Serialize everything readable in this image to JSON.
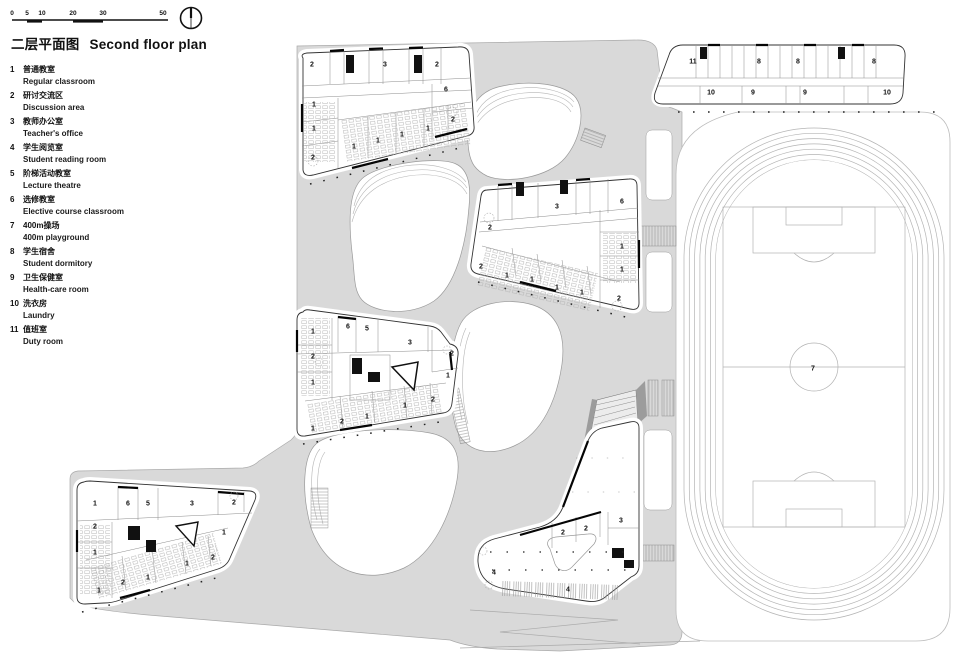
{
  "header": {
    "title_zh": "二层平面图",
    "title_en": "Second floor plan",
    "scale_ticks": [
      {
        "t": "0",
        "x": 2
      },
      {
        "t": "5",
        "x": 17
      },
      {
        "t": "10",
        "x": 32
      },
      {
        "t": "20",
        "x": 63
      },
      {
        "t": "30",
        "x": 93
      },
      {
        "t": "50",
        "x": 153
      }
    ]
  },
  "legend": {
    "items": [
      {
        "num": "1",
        "zh": "普通教室",
        "en": "Regular classroom"
      },
      {
        "num": "2",
        "zh": "研讨交流区",
        "en": "Discussion area"
      },
      {
        "num": "3",
        "zh": "教师办公室",
        "en": "Teacher's office"
      },
      {
        "num": "4",
        "zh": "学生阅览室",
        "en": "Student reading room"
      },
      {
        "num": "5",
        "zh": "阶梯活动教室",
        "en": "Lecture theatre"
      },
      {
        "num": "6",
        "zh": "选修教室",
        "en": "Elective course classroom"
      },
      {
        "num": "7",
        "zh": "400m操场",
        "en": "400m playground"
      },
      {
        "num": "8",
        "zh": "学生宿舍",
        "en": "Student dormitory"
      },
      {
        "num": "9",
        "zh": "卫生保健室",
        "en": "Health-care room"
      },
      {
        "num": "10",
        "zh": "洗衣房",
        "en": "Laundry"
      },
      {
        "num": "11",
        "zh": "值班室",
        "en": "Duty room"
      }
    ]
  },
  "plan": {
    "room_labels": [
      {
        "x": 312,
        "y": 65,
        "t": "2"
      },
      {
        "x": 385,
        "y": 65,
        "t": "3"
      },
      {
        "x": 437,
        "y": 65,
        "t": "2"
      },
      {
        "x": 446,
        "y": 90,
        "t": "6"
      },
      {
        "x": 314,
        "y": 105,
        "t": "1"
      },
      {
        "x": 453,
        "y": 120,
        "t": "2"
      },
      {
        "x": 314,
        "y": 129,
        "t": "1"
      },
      {
        "x": 428,
        "y": 129,
        "t": "1"
      },
      {
        "x": 402,
        "y": 135,
        "t": "1"
      },
      {
        "x": 378,
        "y": 141,
        "t": "1"
      },
      {
        "x": 354,
        "y": 147,
        "t": "1"
      },
      {
        "x": 313,
        "y": 158,
        "t": "2"
      },
      {
        "x": 693,
        "y": 62,
        "t": "11"
      },
      {
        "x": 759,
        "y": 62,
        "t": "8"
      },
      {
        "x": 798,
        "y": 62,
        "t": "8"
      },
      {
        "x": 874,
        "y": 62,
        "t": "8"
      },
      {
        "x": 711,
        "y": 93,
        "t": "10"
      },
      {
        "x": 753,
        "y": 93,
        "t": "9"
      },
      {
        "x": 805,
        "y": 93,
        "t": "9"
      },
      {
        "x": 887,
        "y": 93,
        "t": "10"
      },
      {
        "x": 557,
        "y": 207,
        "t": "3"
      },
      {
        "x": 622,
        "y": 202,
        "t": "6"
      },
      {
        "x": 490,
        "y": 228,
        "t": "2"
      },
      {
        "x": 622,
        "y": 247,
        "t": "1"
      },
      {
        "x": 622,
        "y": 270,
        "t": "1"
      },
      {
        "x": 481,
        "y": 267,
        "t": "2"
      },
      {
        "x": 507,
        "y": 276,
        "t": "1"
      },
      {
        "x": 532,
        "y": 280,
        "t": "1"
      },
      {
        "x": 557,
        "y": 288,
        "t": "1"
      },
      {
        "x": 582,
        "y": 293,
        "t": "1"
      },
      {
        "x": 619,
        "y": 299,
        "t": "2"
      },
      {
        "x": 313,
        "y": 332,
        "t": "1"
      },
      {
        "x": 348,
        "y": 327,
        "t": "6"
      },
      {
        "x": 367,
        "y": 329,
        "t": "5"
      },
      {
        "x": 410,
        "y": 343,
        "t": "3"
      },
      {
        "x": 452,
        "y": 354,
        "t": "2"
      },
      {
        "x": 313,
        "y": 357,
        "t": "2"
      },
      {
        "x": 313,
        "y": 383,
        "t": "1"
      },
      {
        "x": 448,
        "y": 376,
        "t": "1"
      },
      {
        "x": 433,
        "y": 400,
        "t": "2"
      },
      {
        "x": 405,
        "y": 406,
        "t": "1"
      },
      {
        "x": 367,
        "y": 417,
        "t": "1"
      },
      {
        "x": 342,
        "y": 422,
        "t": "2"
      },
      {
        "x": 313,
        "y": 429,
        "t": "1"
      },
      {
        "x": 95,
        "y": 504,
        "t": "1"
      },
      {
        "x": 128,
        "y": 504,
        "t": "6"
      },
      {
        "x": 148,
        "y": 504,
        "t": "5"
      },
      {
        "x": 192,
        "y": 504,
        "t": "3"
      },
      {
        "x": 234,
        "y": 503,
        "t": "2"
      },
      {
        "x": 95,
        "y": 527,
        "t": "2"
      },
      {
        "x": 95,
        "y": 553,
        "t": "1"
      },
      {
        "x": 224,
        "y": 533,
        "t": "1"
      },
      {
        "x": 213,
        "y": 558,
        "t": "2"
      },
      {
        "x": 187,
        "y": 564,
        "t": "1"
      },
      {
        "x": 148,
        "y": 578,
        "t": "1"
      },
      {
        "x": 123,
        "y": 583,
        "t": "2"
      },
      {
        "x": 99,
        "y": 591,
        "t": "1"
      },
      {
        "x": 563,
        "y": 533,
        "t": "2"
      },
      {
        "x": 586,
        "y": 529,
        "t": "2"
      },
      {
        "x": 621,
        "y": 521,
        "t": "3"
      },
      {
        "x": 494,
        "y": 573,
        "t": "4"
      },
      {
        "x": 568,
        "y": 590,
        "t": "4"
      },
      {
        "x": 813,
        "y": 369,
        "t": "7"
      }
    ]
  },
  "colors": {
    "ground": "#d9d9d9",
    "wall": "#111111",
    "thin_line": "#8c8c8c",
    "track_line": "#b2b2b2"
  }
}
